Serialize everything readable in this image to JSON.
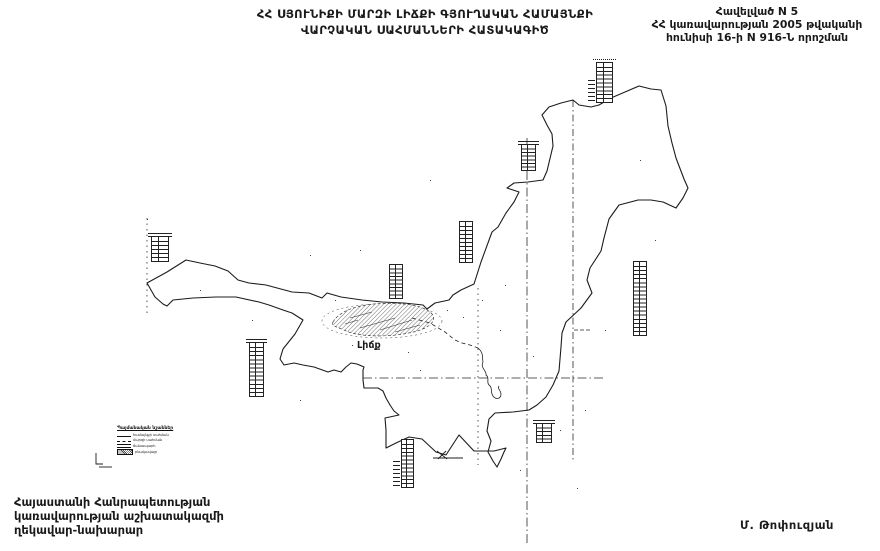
{
  "paper_color": "#ffffff",
  "ink_color": "#1a1a1a",
  "title": {
    "line1": "ՀՀ ՍՅՈՒՆԻՔԻ ՄԱՐԶԻ ԼԻՃՔԻ ԳՅՈՒՂԱԿԱՆ ՀԱՄԱՅՆՔԻ",
    "line2": "ՎԱՐՉԱԿԱՆ ՍԱՀՄԱՆՆԵՐԻ ՀԱՏԱԿԱԳԻԾ"
  },
  "annex": {
    "line1": "Հավելված N 5",
    "line2": "ՀՀ կառավարության 2005 թվականի",
    "line3": "հունիսի 16-ի N 916-Ն որոշման"
  },
  "map": {
    "settlement_label": "Լիճք",
    "legend": {
      "title": "Պայմանական նշաններ",
      "items": [
        {
          "symbol": "line-solid",
          "label": "համայնքի սահման"
        },
        {
          "symbol": "line-dashdot",
          "label": "մարզի սահման"
        },
        {
          "symbol": "line-double",
          "label": "ճանապարհ"
        },
        {
          "symbol": "hatch",
          "label": "բնակավայր"
        }
      ]
    },
    "coordinate_tables": [
      {
        "x": 151,
        "y": 236,
        "w": 18,
        "h": 26,
        "rows": 6,
        "cap": "solid"
      },
      {
        "x": 249,
        "y": 342,
        "w": 15,
        "h": 55,
        "rows": 13,
        "cap": "solid"
      },
      {
        "x": 389,
        "y": 264,
        "w": 14,
        "h": 35,
        "rows": 9,
        "cap": "none"
      },
      {
        "x": 459,
        "y": 221,
        "w": 14,
        "h": 42,
        "rows": 10,
        "cap": "none"
      },
      {
        "x": 521,
        "y": 144,
        "w": 15,
        "h": 27,
        "rows": 7,
        "cap": "solid"
      },
      {
        "x": 596,
        "y": 62,
        "w": 17,
        "h": 41,
        "rows": 10,
        "cap": "dotted",
        "leftMarks": true
      },
      {
        "x": 633,
        "y": 261,
        "w": 14,
        "h": 75,
        "rows": 18,
        "cap": "none"
      },
      {
        "x": 401,
        "y": 439,
        "w": 13,
        "h": 49,
        "rows": 12,
        "cap": "none",
        "leftMarks": true
      },
      {
        "x": 536,
        "y": 423,
        "w": 16,
        "h": 20,
        "rows": 5,
        "cap": "solid"
      }
    ]
  },
  "footer": {
    "line1": "Հայաստանի Հանրապետության",
    "line2": "կառավարության աշխատակազմի",
    "line3": "ղեկավար-նախարար",
    "signature": "Մ. Թոփուզյան"
  }
}
